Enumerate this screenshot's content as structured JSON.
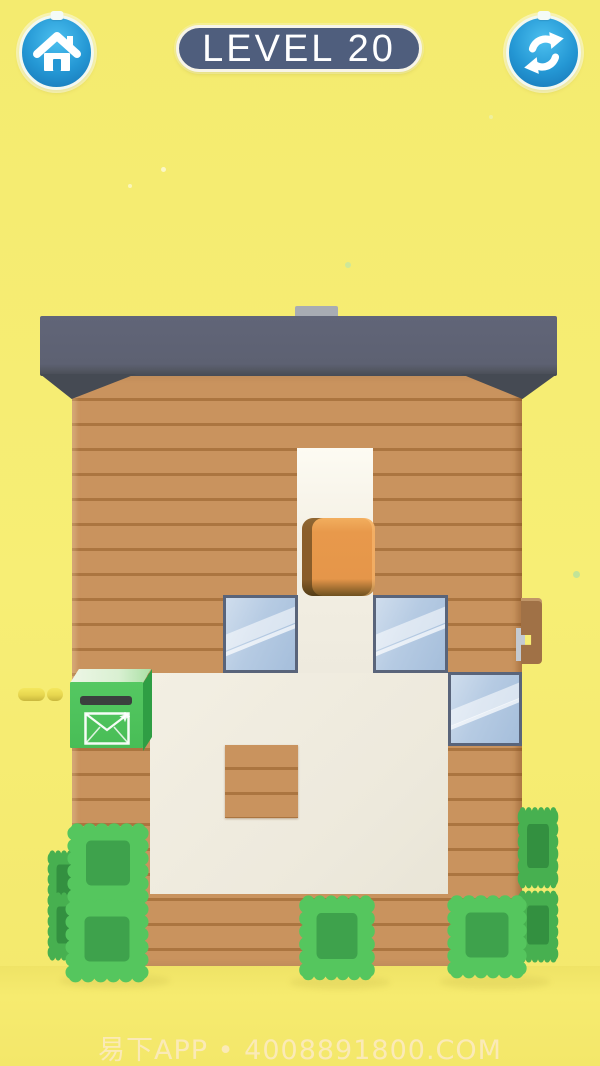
{
  "header": {
    "level_badge": "LEVEL 20",
    "home_button": {
      "icon": "home-icon"
    },
    "restart_button": {
      "icon": "refresh-icon"
    }
  },
  "board": {
    "house": {
      "parts": [
        "gray-roof",
        "chimney",
        "wood-plank-wall",
        "cream-interior"
      ],
      "blocks": {
        "orange_cube_count": 1,
        "glass_window_count": 3,
        "mailbox_count": 1,
        "wood_peg_count": 1,
        "bush_count": 8,
        "coin_count": 2
      }
    }
  },
  "colors": {
    "background_yellow": "#f5ed72",
    "roof_gray": "#5d6172",
    "chimney_gray": "#a8acb3",
    "wood_tan": "#c9935e",
    "interior_cream": "#efebdf",
    "orange_block": "#e5964a",
    "window_glass": "#b6cbe3",
    "window_frame": "#59647a",
    "mailbox_green": "#48bd56",
    "bush_green": "#52c45c",
    "badge_blue": "#4f5e7d",
    "button_blue": "#2497d4"
  },
  "watermark": {
    "text": "易下APP • 4008891800.COM"
  }
}
